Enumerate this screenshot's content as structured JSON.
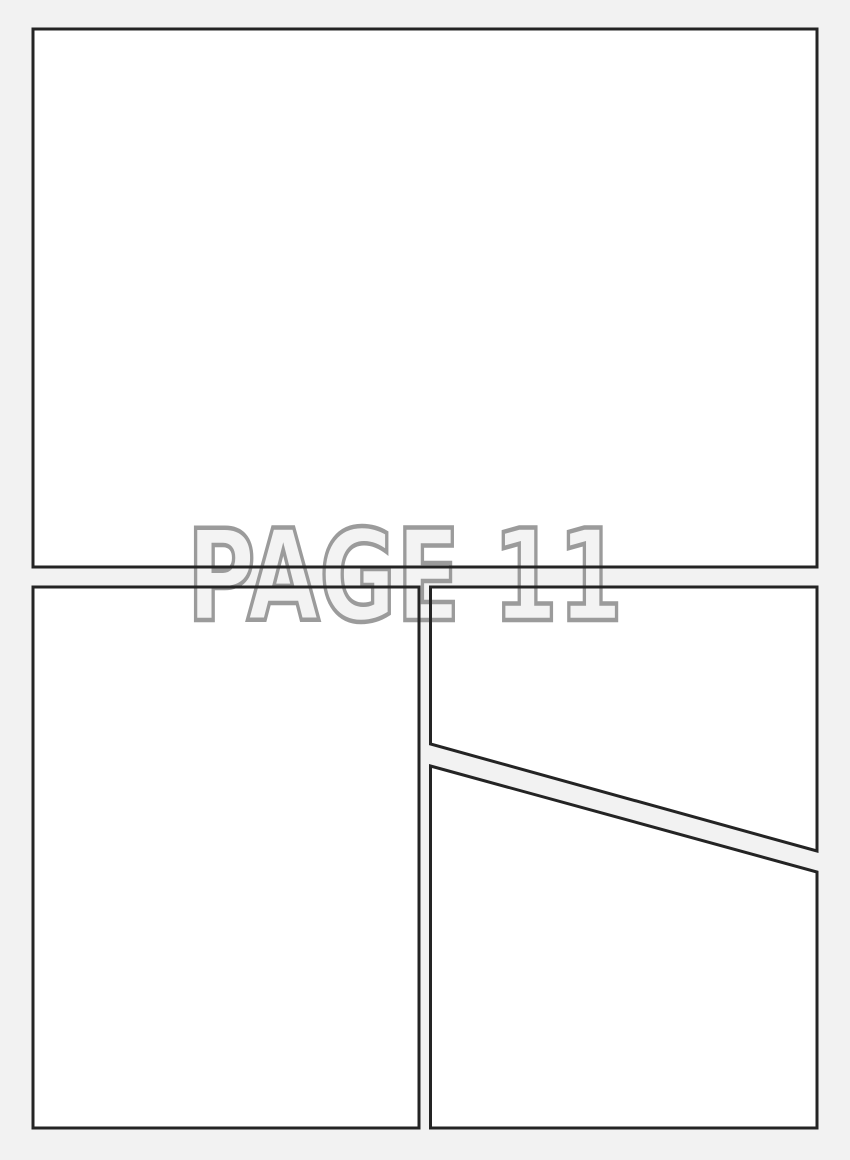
{
  "page": {
    "kind": "comic-page-template",
    "label": "PAGE 11"
  },
  "watermark": {
    "text": "PAGE 11"
  },
  "colors": {
    "page_background": "#f2f2f2",
    "panel_fill": "#ffffff",
    "panel_border": "#242424",
    "watermark_fill": "#f3f3f3",
    "watermark_stroke": "#9b9b9b"
  }
}
